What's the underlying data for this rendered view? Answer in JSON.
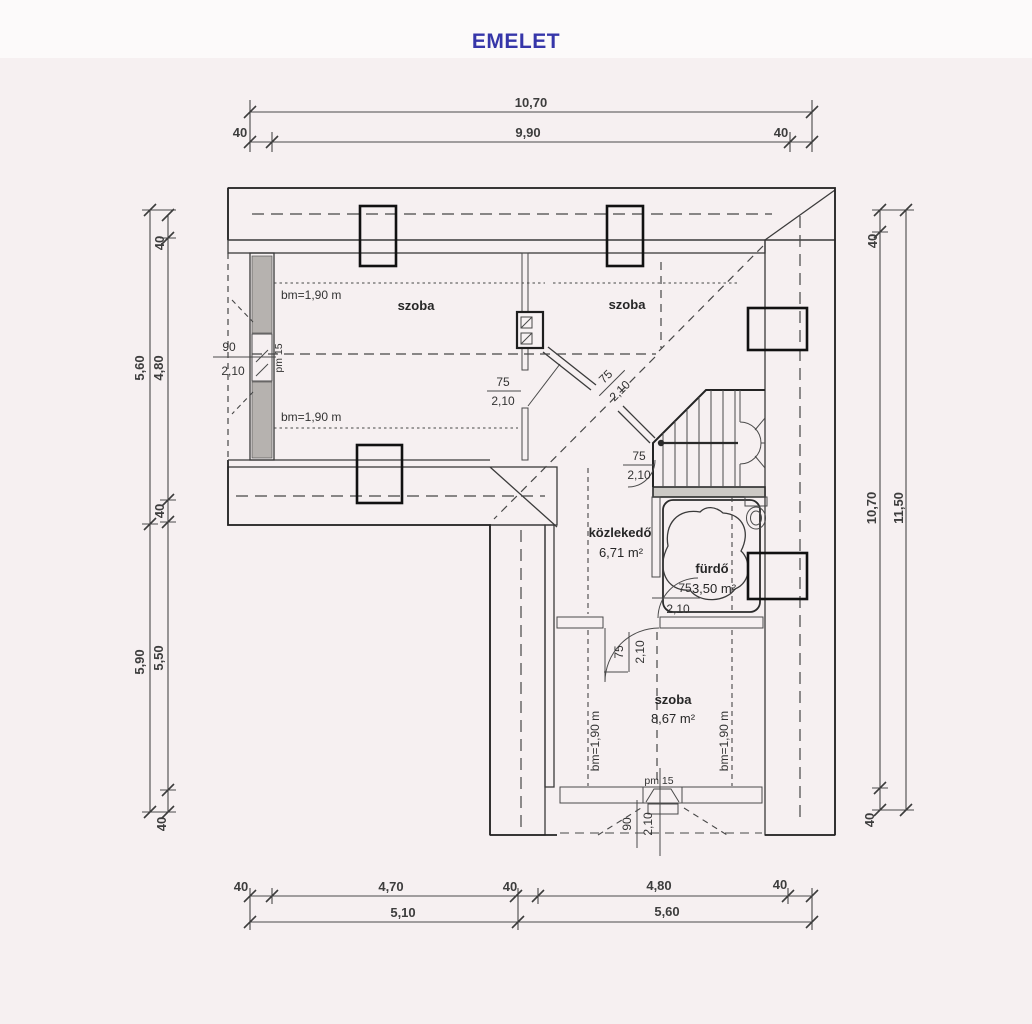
{
  "title": "EMELET",
  "rooms": {
    "szoba_top_left": "szoba",
    "szoba_top_right": "szoba",
    "kozlekedo": "közlekedő",
    "kozlekedo_area": "6,71 m²",
    "furdo": "fürdő",
    "furdo_area": "3,50 m²",
    "szoba_bottom": "szoba",
    "szoba_bottom_area": "8,67 m²"
  },
  "heights": {
    "bm_top_upper": "bm=1,90 m",
    "bm_top_lower": "bm=1,90 m",
    "bm_bottom_left": "bm=1,90 m",
    "bm_bottom_right": "bm=1,90 m"
  },
  "openings": {
    "left_window_w": "90",
    "left_window_h": "2,10",
    "left_window_pm": "pm 15",
    "door1_w": "75",
    "door1_h": "2,10",
    "door2_w": "75",
    "door2_h": "2,10",
    "door3_w": "75",
    "door3_h": "2,10",
    "door4_w": "75",
    "door4_h": "2,10",
    "door5_w": "75",
    "door5_h": "2,10",
    "bottom_window_w": "90",
    "bottom_window_h": "2,10",
    "bottom_window_pm": "pm 15"
  },
  "dims": {
    "top_overall": "10,70",
    "top_40l": "40",
    "top_inner": "9,90",
    "top_40r": "40",
    "left_upper_outer": "5,60",
    "left_lower_outer": "5,90",
    "left_40t": "40",
    "left_upper_inner": "4,80",
    "left_40m": "40",
    "left_lower_inner": "5,50",
    "left_40b": "40",
    "right_40t": "40",
    "right_inner": "10,70",
    "right_outer": "11,50",
    "right_40b": "40",
    "bot_40l": "40",
    "bot_470": "4,70",
    "bot_40m": "40",
    "bot_480": "4,80",
    "bot_40r": "40",
    "bot_510": "5,10",
    "bot_560": "5,60"
  }
}
